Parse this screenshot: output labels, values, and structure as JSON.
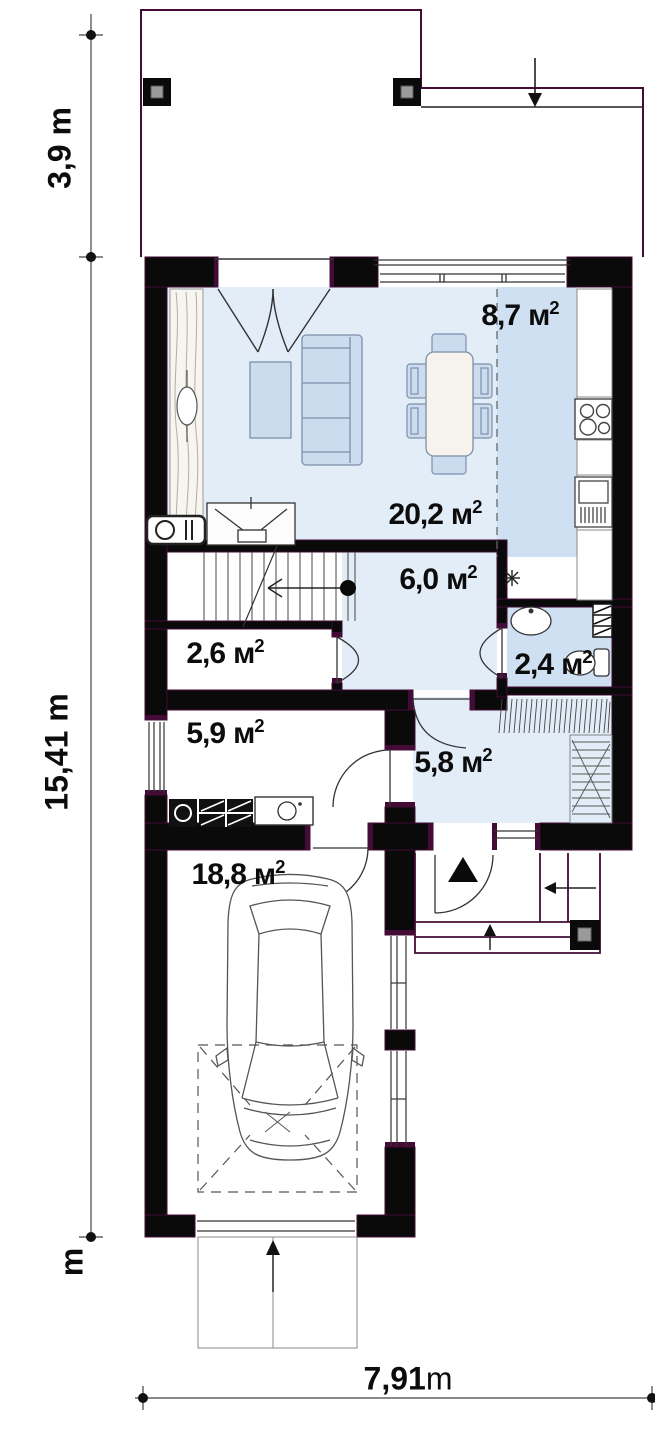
{
  "dimensions": {
    "left_top": "3,9 m",
    "left_main": "15,41 m",
    "left_bottom_unit": "m",
    "bottom_value": "7,91",
    "bottom_unit": "m"
  },
  "rooms": [
    {
      "id": "kitchen",
      "area": "8,7",
      "unit": "м",
      "sup": "2"
    },
    {
      "id": "living-dining",
      "area": "20,2",
      "unit": "м",
      "sup": "2"
    },
    {
      "id": "hall",
      "area": "6,0",
      "unit": "м",
      "sup": "2"
    },
    {
      "id": "storage",
      "area": "2,6",
      "unit": "м",
      "sup": "2"
    },
    {
      "id": "bathroom",
      "area": "2,4",
      "unit": "м",
      "sup": "2"
    },
    {
      "id": "utility",
      "area": "5,9",
      "unit": "м",
      "sup": "2"
    },
    {
      "id": "vestibule",
      "area": "5,8",
      "unit": "м",
      "sup": "2"
    },
    {
      "id": "garage",
      "area": "18,8",
      "unit": "м",
      "sup": "2"
    }
  ],
  "colors": {
    "wall": "#0a0a0a",
    "wall_outline_purple": "#430b36",
    "floor_light_blue": "#e3edf8",
    "floor_medium_blue": "#cfe0f2",
    "furniture_fill": "#ccdcee",
    "furniture_stroke": "#7d90aa",
    "dimension_line": "#444444"
  }
}
